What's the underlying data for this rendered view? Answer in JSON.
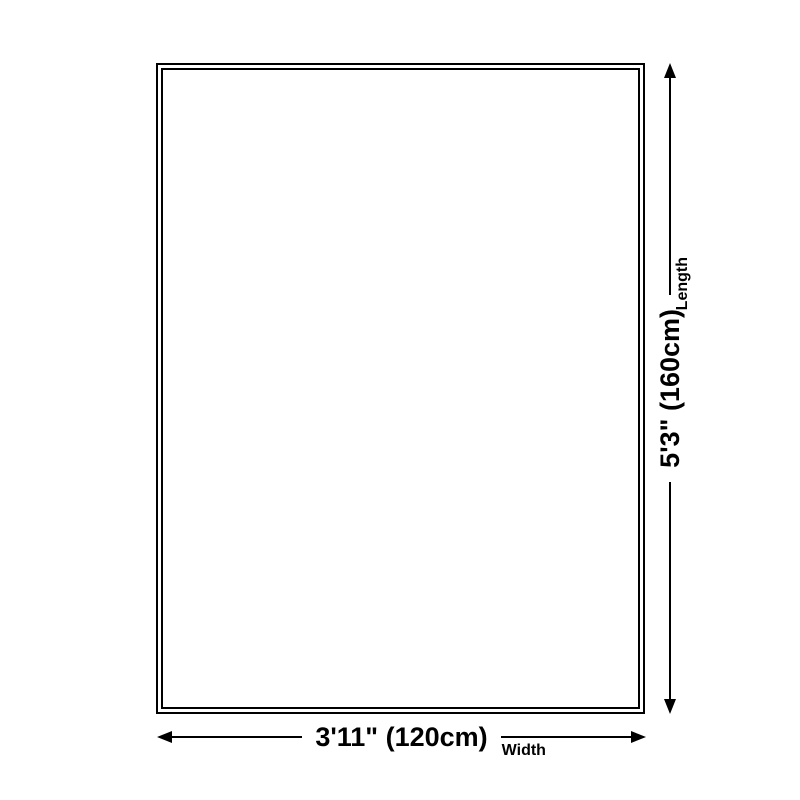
{
  "diagram": {
    "title": "rug-size-diagram",
    "background_color": "#ffffff",
    "line_color": "#000000",
    "text_color": "#000000",
    "dimensions": {
      "width": {
        "value": "3'11\" (120cm)",
        "label": "Width"
      },
      "length": {
        "value": "5'3\" (160cm)",
        "label": "Length"
      }
    }
  }
}
